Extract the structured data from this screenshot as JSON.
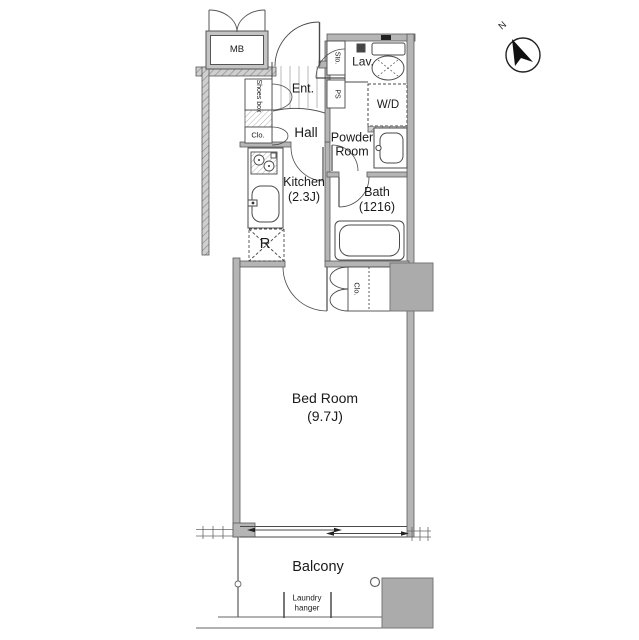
{
  "labels": {
    "mb": "MB",
    "shoes_box": "Shoes box",
    "sto": "Sto.",
    "ps": "PS",
    "entrance": "Ent.",
    "lavatory": "Lav.",
    "washer_dryer": "W/D",
    "closet_hall": "Clo.",
    "hall": "Hall",
    "powder_room": "Powder Room",
    "kitchen": "Kitchen\n(2.3J)",
    "bath": "Bath\n(1216)",
    "refrigerator": "R",
    "closet_bedroom": "Clo.",
    "bedroom": "Bed Room\n(9.7J)",
    "balcony": "Balcony",
    "laundry_hanger": "Laundry hanger",
    "north": "N"
  },
  "colors": {
    "wall": "#b5b5b5",
    "pillar": "#ababab",
    "line": "#4a4a4a",
    "text": "#1a1a1a",
    "background": "#ffffff"
  }
}
